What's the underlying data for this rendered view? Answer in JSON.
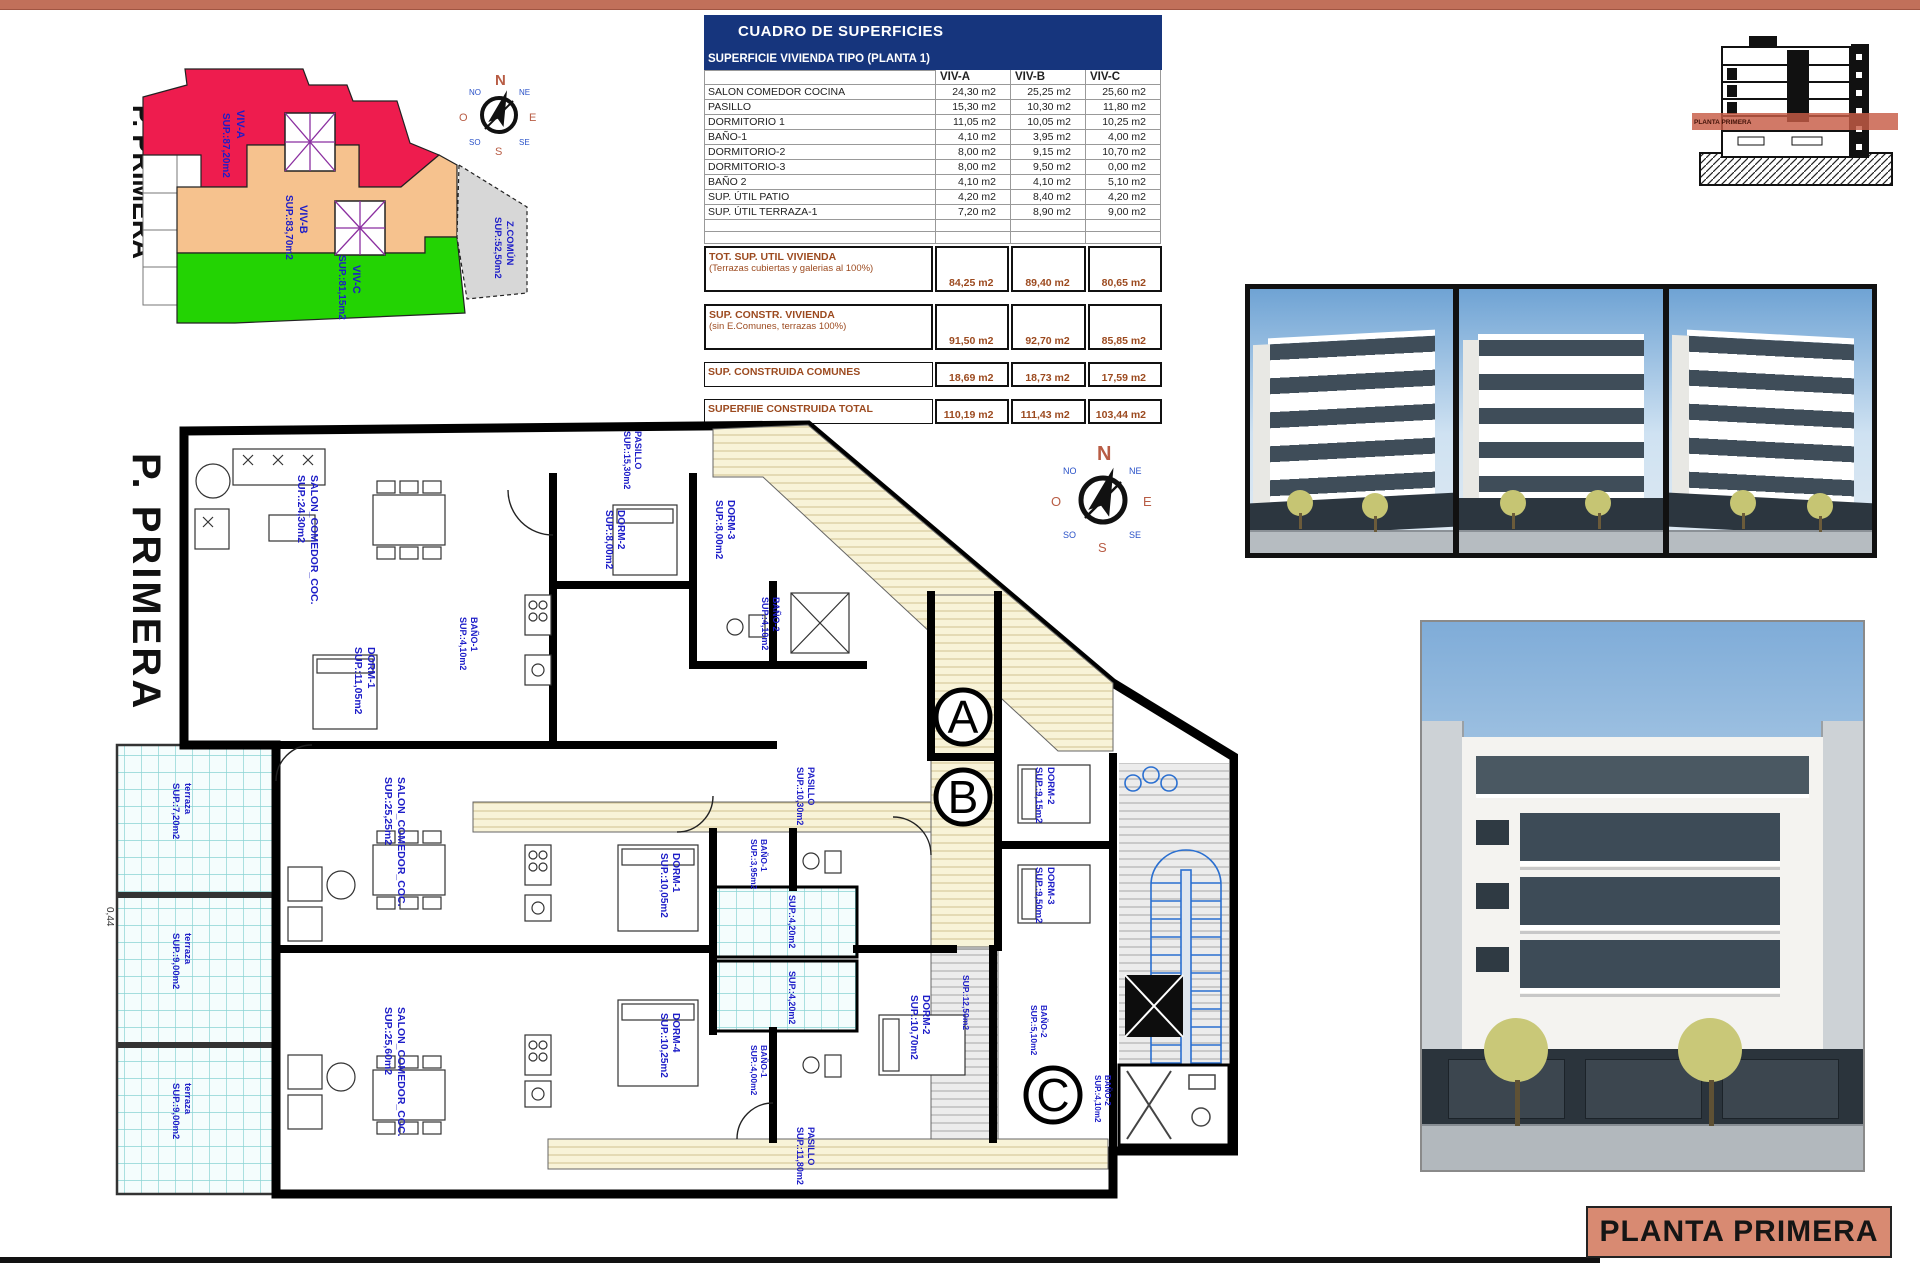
{
  "page": {
    "sheet_title": "PLANTA PRIMERA"
  },
  "key_plan": {
    "side_label": "P. PRIMERA",
    "zones": [
      {
        "name": "VIV-A",
        "sup": "SUP.:87,20m2"
      },
      {
        "name": "VIV-B",
        "sup": "SUP.:83,70m2"
      },
      {
        "name": "VIV-C",
        "sup": "SUP.:81,15m2"
      },
      {
        "name": "Z.COMÚN",
        "sup": "SUP.:52,50m2"
      }
    ]
  },
  "compass": {
    "n": "N",
    "s": "S",
    "e": "E",
    "o": "O",
    "ne": "NE",
    "no": "NO",
    "se": "SE",
    "so": "SO"
  },
  "table": {
    "title": "CUADRO DE SUPERFICIES",
    "subtitle": "SUPERFICIE VIVIENDA TIPO  (PLANTA 1)",
    "columns": [
      "VIV-A",
      "VIV-B",
      "VIV-C"
    ],
    "rows": [
      {
        "label": "SALON COMEDOR COCINA",
        "a": "24,30 m2",
        "b": "25,25 m2",
        "c": "25,60 m2"
      },
      {
        "label": "PASILLO",
        "a": "15,30 m2",
        "b": "10,30 m2",
        "c": "11,80 m2"
      },
      {
        "label": "DORMITORIO 1",
        "a": "11,05 m2",
        "b": "10,05 m2",
        "c": "10,25 m2"
      },
      {
        "label": "BAÑO-1",
        "a": "4,10 m2",
        "b": "3,95 m2",
        "c": "4,00 m2"
      },
      {
        "label": "DORMITORIO-2",
        "a": "8,00 m2",
        "b": "9,15 m2",
        "c": "10,70 m2"
      },
      {
        "label": "DORMITORIO-3",
        "a": "8,00 m2",
        "b": "9,50 m2",
        "c": "0,00 m2"
      },
      {
        "label": "BAÑO 2",
        "a": "4,10 m2",
        "b": "4,10 m2",
        "c": "5,10 m2"
      },
      {
        "label": "SUP. ÚTIL PATIO",
        "a": "4,20 m2",
        "b": "8,40 m2",
        "c": "4,20 m2"
      },
      {
        "label": "SUP. ÚTIL TERRAZA-1",
        "a": "7,20 m2",
        "b": "8,90 m2",
        "c": "9,00 m2"
      }
    ],
    "totals": [
      {
        "label": "TOT. SUP. UTIL VIVIENDA",
        "sublabel": "(Terrazas cubiertas y galerias al 100%)",
        "a": "84,25 m2",
        "b": "89,40 m2",
        "c": "80,65 m2"
      },
      {
        "label": "SUP. CONSTR. VIVIENDA",
        "sublabel": "(sin E.Comunes, terrazas 100%)",
        "a": "91,50 m2",
        "b": "92,70 m2",
        "c": "85,85 m2"
      },
      {
        "label": "SUP. CONSTRUIDA COMUNES",
        "sublabel": "",
        "a": "18,69 m2",
        "b": "18,73 m2",
        "c": "17,59 m2"
      },
      {
        "label": "SUPERFIIE CONSTRUIDA TOTAL",
        "sublabel": "",
        "a": "110,19 m2",
        "b": "111,43 m2",
        "c": "103,44 m2"
      }
    ]
  },
  "section": {
    "band_label": "PLANTA PRIMERA"
  },
  "plan": {
    "side_label": "P. PRIMERA",
    "dimension": "0,44",
    "markers": [
      "A",
      "B",
      "C"
    ],
    "rooms": [
      {
        "name": "SALON_COMEDOR_COC.",
        "sup": "SUP.:24,30m2"
      },
      {
        "name": "DORM-2",
        "sup": "SUP.:8,00m2"
      },
      {
        "name": "DORM-3",
        "sup": "SUP.:8,00m2"
      },
      {
        "name": "BAÑO-2",
        "sup": "SUP.:4,10m2"
      },
      {
        "name": "DORM-1",
        "sup": "SUP.:11,05m2"
      },
      {
        "name": "BAÑO-1",
        "sup": "SUP.:4,10m2"
      },
      {
        "name": "PASILLO",
        "sup": "SUP.:15,30m2"
      },
      {
        "name": "terraza",
        "sup": "SUP.:7,20m2"
      },
      {
        "name": "terraza",
        "sup": "SUP.:9,00m2"
      },
      {
        "name": "terraza",
        "sup": "SUP.:9,00m2"
      },
      {
        "name": "SALON_COMEDOR_COC.",
        "sup": "SUP.:25,25m2"
      },
      {
        "name": "SALON_COMEDOR_COC.",
        "sup": "SUP.:25,60m2"
      },
      {
        "name": "DORM-1",
        "sup": "SUP.:10,05m2"
      },
      {
        "name": "DORM-4",
        "sup": "SUP.:10,25m2"
      },
      {
        "name": "BAÑO-1",
        "sup": "SUP.:3,95m2"
      },
      {
        "name": "BAÑO-1",
        "sup": "SUP.:4,00m2"
      },
      {
        "name": "",
        "sup": "SUP.:4,20m2"
      },
      {
        "name": "",
        "sup": "SUP.:4,20m2"
      },
      {
        "name": "PASILLO",
        "sup": "SUP.:10,30m2"
      },
      {
        "name": "PASILLO",
        "sup": "SUP.:11,80m2"
      },
      {
        "name": "DORM-2",
        "sup": "SUP.:9,15m2"
      },
      {
        "name": "DORM-3",
        "sup": "SUP.:9,50m2"
      },
      {
        "name": "DORM-2",
        "sup": "SUP.:10,70m2"
      },
      {
        "name": "BAÑO-2",
        "sup": "SUP.:5,10m2"
      },
      {
        "name": "BAÑO-2",
        "sup": "SUP.:4,10m2"
      },
      {
        "name": "",
        "sup": "SUP.:12,50m2"
      }
    ]
  }
}
